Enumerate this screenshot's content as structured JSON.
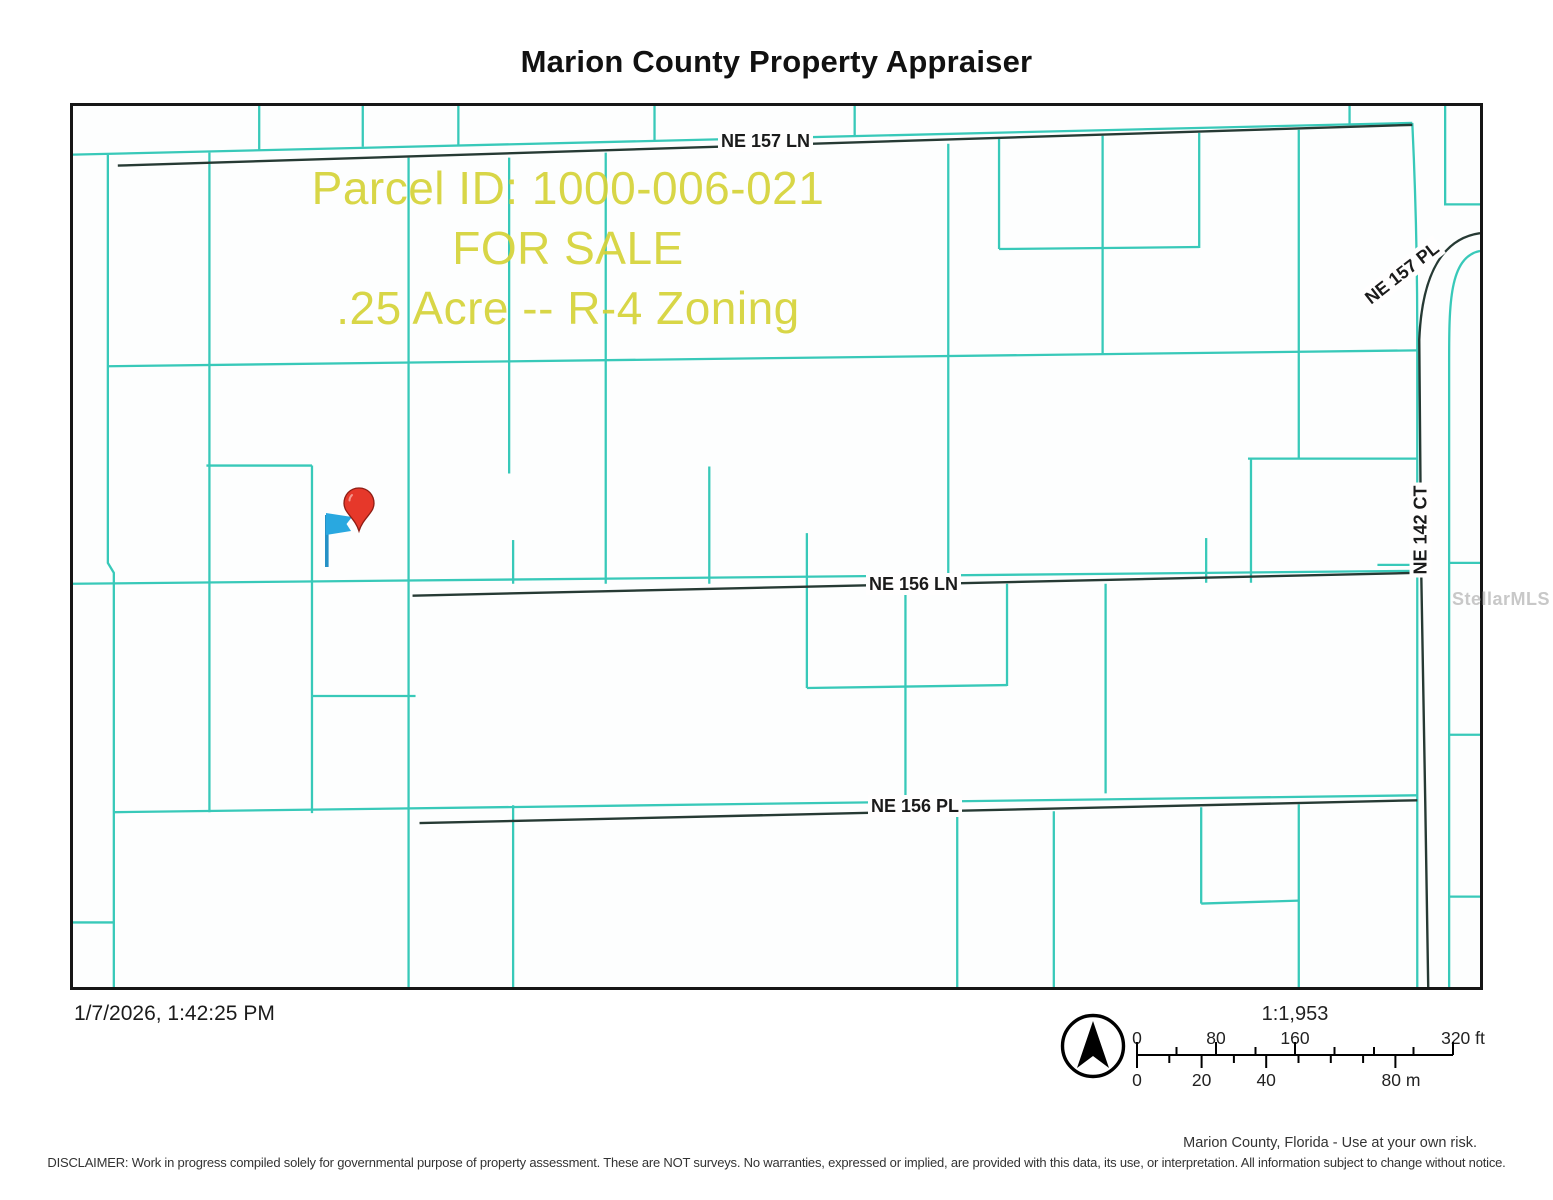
{
  "page": {
    "title": "Marion County Property Appraiser"
  },
  "map": {
    "overlay": {
      "line1": "Parcel ID: 1000-006-021",
      "line2": "FOR SALE",
      "line3": ".25 Acre -- R-4 Zoning",
      "text_color": "#d5d338"
    },
    "streets": {
      "ne157ln": "NE 157 LN",
      "ne157pl": "NE 157 PL",
      "ne142ct": "NE 142 CT",
      "ne156ln": "NE 156 LN",
      "ne156pl": "NE 156 PL"
    },
    "colors": {
      "parcel_line": "#38c9b9",
      "road_line": "#263a34",
      "border": "#161616",
      "pin": "#e6382a",
      "flag": "#29a8e0"
    },
    "watermark": "StellarMLS"
  },
  "footer": {
    "timestamp": "1/7/2026, 1:42:25 PM",
    "scale_ratio": "1:1,953",
    "ft_labels": [
      "0",
      "80",
      "160",
      "320 ft"
    ],
    "m_labels": [
      "0",
      "20",
      "40",
      "80 m"
    ],
    "attribution": "Marion County, Florida - Use at your own risk.",
    "disclaimer": "DISCLAIMER: Work in progress compiled solely for governmental purpose of property assessment. These are NOT surveys. No warranties, expressed or implied, are provided with this data, its use, or interpretation. All information subject to change without notice."
  }
}
